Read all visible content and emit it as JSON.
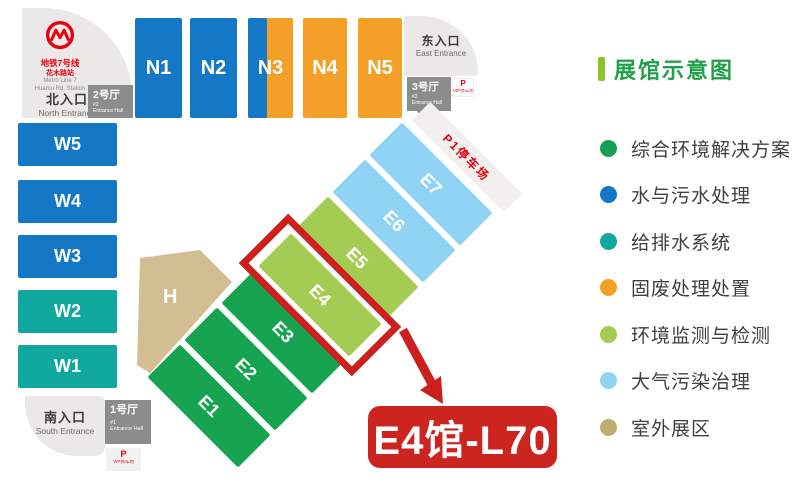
{
  "map": {
    "metro": {
      "line_zh": "地铁7号线",
      "station_zh": "花木路站",
      "line_en": "Metro Line 7",
      "station_en": "Huamu Rd. Station"
    },
    "entrances": {
      "north_zh": "北入口",
      "north_en": "North Entrance",
      "east_zh": "东入口",
      "east_en": "East Entrance",
      "south_zh": "南入口",
      "south_en": "South Entrance"
    },
    "entrance_halls": {
      "h1_zh": "1号厅",
      "h1_num": "#1",
      "h1_en": "Entrance Hall",
      "h2_zh": "2号厅",
      "h2_num": "#2",
      "h2_en": "Entrance Hall",
      "h3_zh": "3号厅",
      "h3_num": "#3",
      "h3_en": "Entrance Hall"
    },
    "parking": {
      "p": "P",
      "vip": "VIP停车场",
      "p1": "P1停车场"
    },
    "halls": {
      "north": [
        "N1",
        "N2",
        "N3",
        "N4",
        "N5"
      ],
      "west": [
        "W5",
        "W4",
        "W3",
        "W2",
        "W1"
      ],
      "east": [
        "E1",
        "E2",
        "E3",
        "E4",
        "E5",
        "E6",
        "E7"
      ],
      "center": "H"
    },
    "highlight_label": "E4馆-L70"
  },
  "legend": {
    "title": "展馆示意图",
    "items": [
      {
        "label": "综合环境解决方案",
        "color": "#17a054"
      },
      {
        "label": "水与污水处理",
        "color": "#1578c6"
      },
      {
        "label": "给排水系统",
        "color": "#10a79f"
      },
      {
        "label": "固废处理处置",
        "color": "#f4a028"
      },
      {
        "label": "环境监测与检测",
        "color": "#a4cc52"
      },
      {
        "label": "大气污染治理",
        "color": "#8fd2f3"
      },
      {
        "label": "室外展区",
        "color": "#bead6f"
      }
    ]
  },
  "colors": {
    "hall_blue": "#1578c6",
    "hall_teal": "#10a79f",
    "hall_orange": "#f4a028",
    "hall_green": "#16a350",
    "hall_light_green": "#a4cc52",
    "hall_light_blue": "#8fd2f3",
    "hall_tan": "#d2be92",
    "entrance_gray": "#ebe9e7",
    "hall_box_gray": "#8c8c8c",
    "highlight_red": "#cc2020",
    "metro_red": "#e60012",
    "legend_title_green": "#1fa149"
  }
}
